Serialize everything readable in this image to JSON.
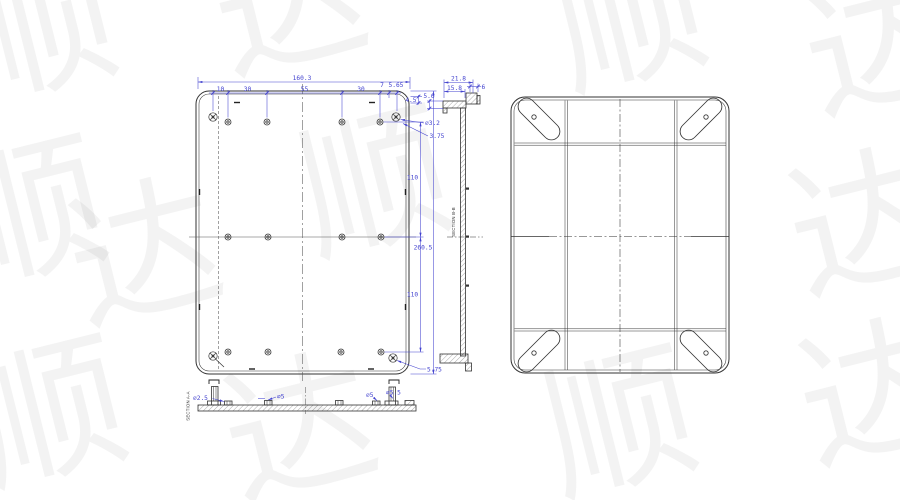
{
  "watermark": {
    "glyphs": [
      "顺",
      "达",
      "顺",
      "达",
      "顺",
      "达",
      "顺",
      "达",
      "顺",
      "达",
      "顺",
      "达"
    ]
  },
  "colors": {
    "background": "#ffffff",
    "drawing_lines": "#333333",
    "dimension_lines": "#4343cf"
  },
  "front_view": {
    "dim_total_width": "160.3",
    "chain": [
      "10",
      "30",
      "55",
      "30",
      "7",
      "5.65"
    ],
    "dim_corner_offset": "4.5",
    "dim_hole_dia": "∅3.2",
    "dim_hole_offset": "3.75",
    "dim_row_upper": "110",
    "dim_height_overall": "260.5",
    "dim_row_lower": "110",
    "dim_screw_offset": "5.75"
  },
  "section_b_view": {
    "label": "SECTION B-B",
    "dim_flange_od": "21.8",
    "dim_flange_id": "15.8",
    "dim_lip": "6",
    "dim_step": "5.6"
  },
  "section_a_view": {
    "label": "SECTION A-A",
    "dim_post_dia": "∅2.5",
    "dim_boss_dia": "∅5",
    "dim_right_boss_dia": "∅5",
    "dim_right_post_dia": "∅5.5"
  }
}
